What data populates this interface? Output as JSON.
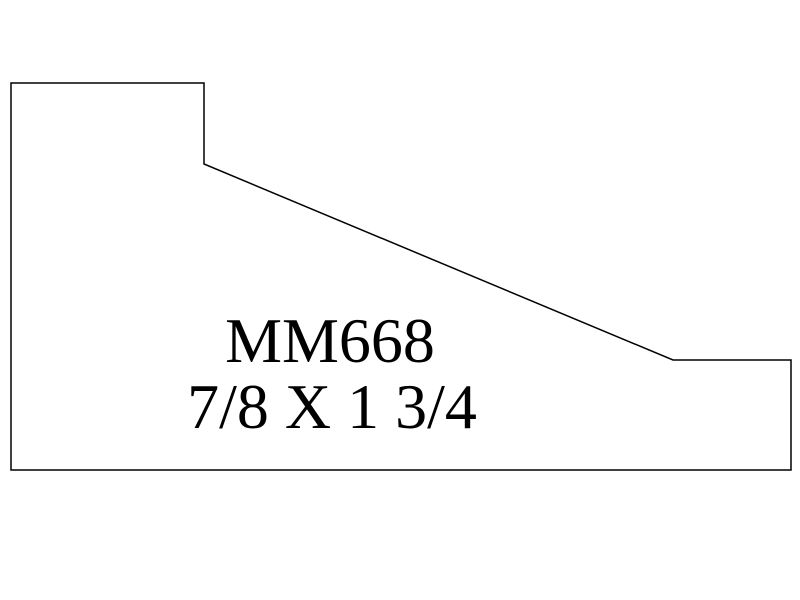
{
  "diagram": {
    "title": "MM668",
    "dimensions": "7/8 X 1 3/4",
    "outline_color": "#000000",
    "background_color": "#ffffff",
    "text_color": "#000000",
    "profile_points": "11,83 204,83 204,164 673,360 791,360 791,470 11,470",
    "stroke_width": "1.5"
  }
}
